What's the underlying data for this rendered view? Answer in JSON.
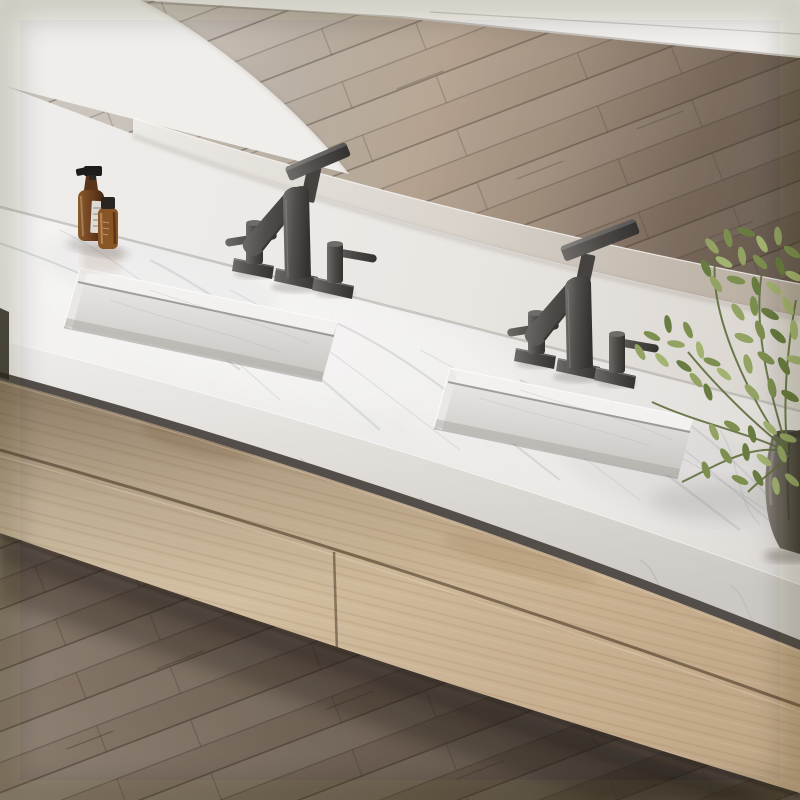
{
  "scene": {
    "description": "Photorealistic render of a wall-mounted double-sink bathroom vanity: white Carrara-style marble slab countertop with two rectangular ramp sinks, marble backsplash shelf with dark metal brackets, two matte gunmetal three-piece widespread faucets, amber glass soap bottles on the left, leafy green plant in a dark cylindrical vase on the right, floating light-oak drawer cabinet below, wood plank floor above and below, white wall with large white arched form at top left",
    "labels": {
      "photo": "bathroom vanity product photograph",
      "floor_upper": "wood plank floor behind vanity",
      "floor_lower": "wood plank floor below vanity",
      "baseboard": "white wall baseboard",
      "arch": "white arched form",
      "ledge": "marble backsplash shelf",
      "bracket": "dark metal shelf bracket",
      "backsplash": "white backsplash face",
      "countertop": "white marble countertop slab",
      "sink_left": "left rectangular ramp sink",
      "sink_right": "right rectangular ramp sink",
      "faucet_left": "left gunmetal widespread faucet",
      "faucet_right": "right gunmetal widespread faucet",
      "bottles": "amber glass bottles",
      "cabinet": "floating light oak drawer cabinet",
      "plant": "green plant in dark vase"
    },
    "counts": {
      "sinks": 2,
      "faucets": 2,
      "handles_per_faucet": 2,
      "bottles": 2,
      "drawer_seams": 2,
      "brackets": 2
    }
  },
  "colors": {
    "wall": "#efedea",
    "baseboard": "#f2f0ed",
    "floor-upper-light": "#c7c0b8",
    "floor-upper-warm": "#b4a28f",
    "floor-upper-dark": "#60544a",
    "floor-lower": "#6e6155",
    "marble": "#f2f1ef",
    "marble-vein": "#a9adb1",
    "backsplash": "#eceae7",
    "ledge": "#d9d3cb",
    "oak": "#cdb798",
    "oak-shadow": "#8c7a64",
    "metal": "#4c4946",
    "amber": "#6e4220",
    "bottle-label": "#e8e6e2",
    "leaf": "#8fa05e",
    "leaf-dark": "#687b40",
    "vase": "#6a655e",
    "shadow": "#241d16"
  }
}
